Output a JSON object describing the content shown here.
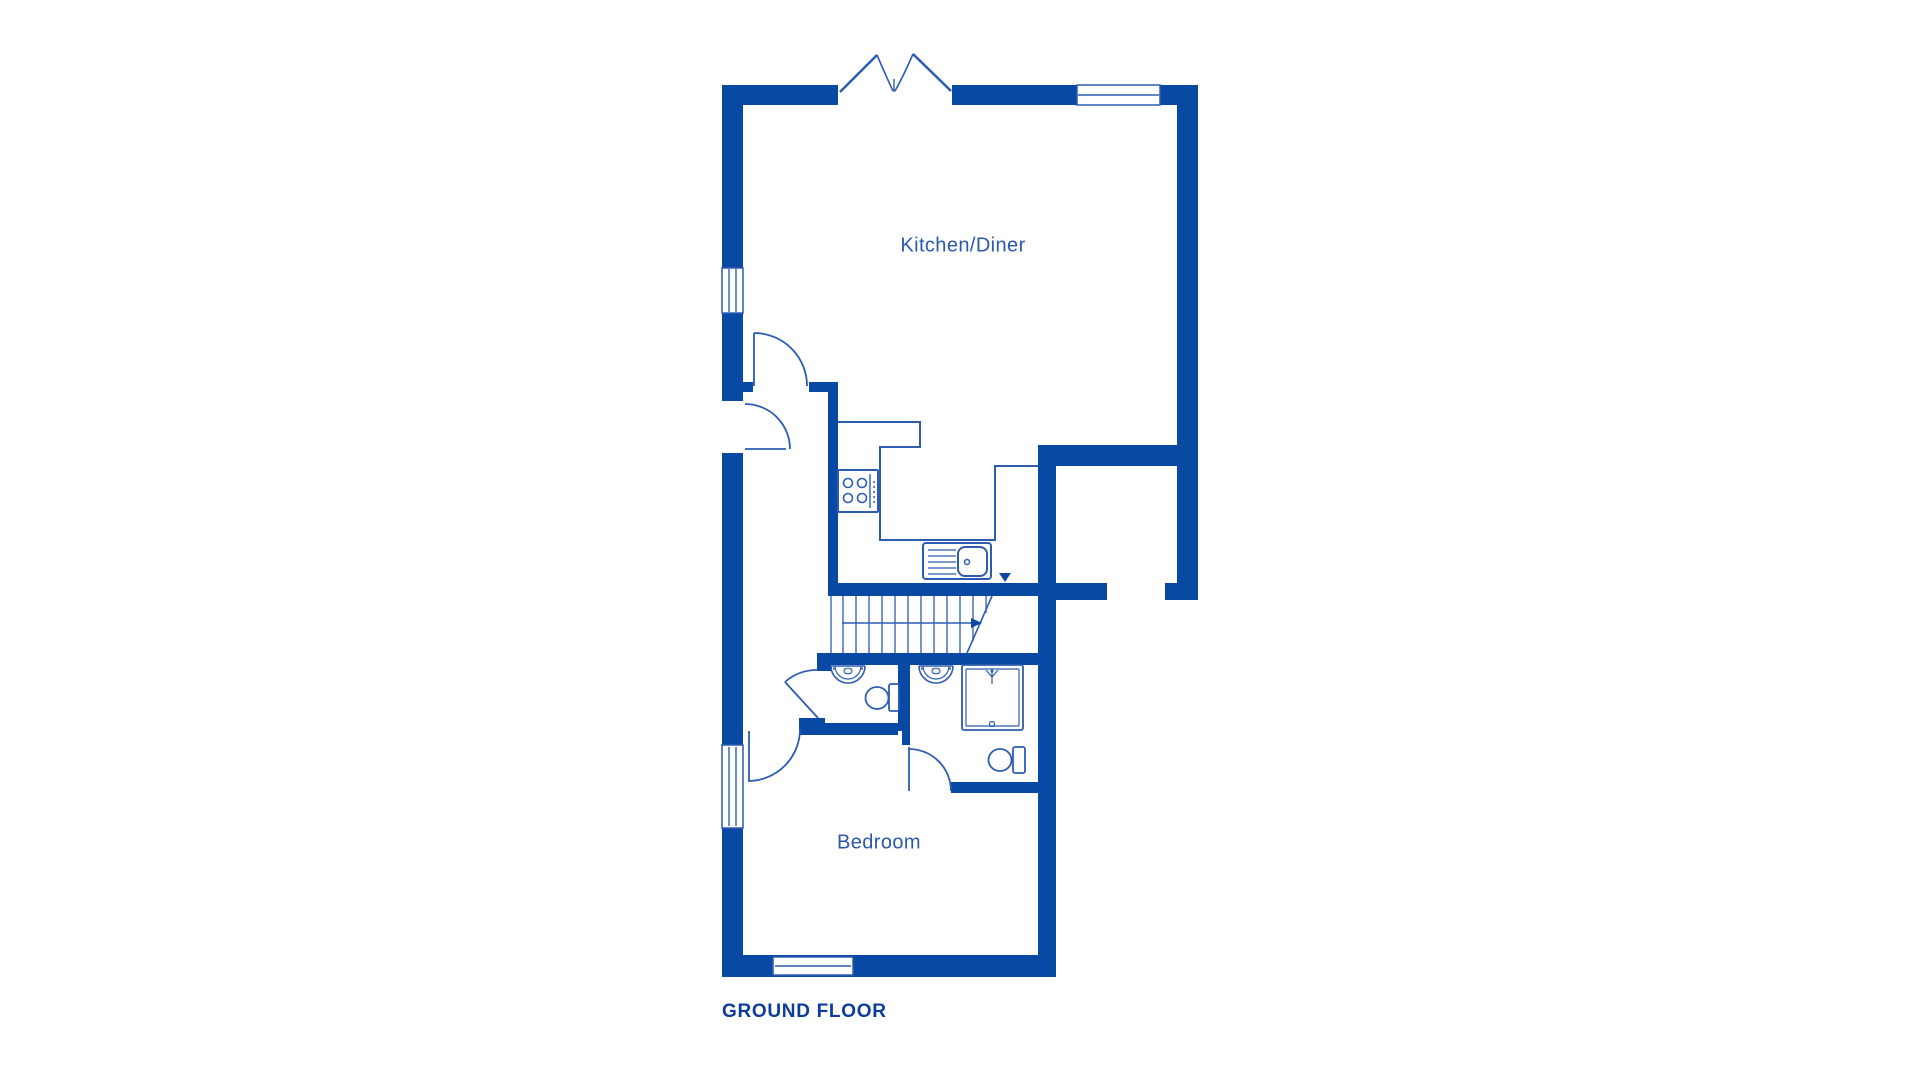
{
  "labels": {
    "kitchen": "Kitchen/Diner",
    "bedroom": "Bedroom",
    "floor_title": "GROUND FLOOR"
  },
  "colors": {
    "wall": "#0849a4",
    "line": "#2d5cb0",
    "label_text": "#2a58ac",
    "floor_title_text": "#0d3c9b",
    "background": "#ffffff"
  },
  "plan": {
    "wallRects": [
      [
        722,
        85,
        116,
        20
      ],
      [
        952,
        85,
        246,
        20
      ],
      [
        1177,
        85,
        21,
        498
      ],
      [
        1165,
        583,
        33,
        17
      ],
      [
        722,
        85,
        21,
        183
      ],
      [
        722,
        313,
        21,
        88
      ],
      [
        722,
        453,
        21,
        292
      ],
      [
        722,
        828,
        21,
        149
      ],
      [
        722,
        955,
        333,
        22
      ],
      [
        1038,
        445,
        140,
        21
      ],
      [
        1038,
        445,
        18,
        532
      ],
      [
        1038,
        583,
        69,
        17
      ],
      [
        828,
        583,
        211,
        13
      ],
      [
        828,
        382,
        10,
        205
      ],
      [
        722,
        382,
        31,
        10
      ],
      [
        809,
        382,
        29,
        10
      ],
      [
        817,
        653,
        238,
        12
      ],
      [
        817,
        665,
        14,
        6
      ],
      [
        799,
        718,
        26,
        17
      ],
      [
        802,
        723,
        96,
        12
      ],
      [
        898,
        653,
        12,
        78
      ],
      [
        902,
        731,
        8,
        14
      ],
      [
        951,
        782,
        104,
        11
      ]
    ],
    "windowRects": [
      [
        722,
        268,
        21,
        45
      ],
      [
        722,
        745,
        21,
        83
      ],
      [
        1077,
        85,
        83,
        20
      ],
      [
        773,
        957,
        80,
        18
      ]
    ],
    "lines": [
      [
        729,
        269,
        729,
        312,
        1.4
      ],
      [
        736,
        269,
        736,
        312,
        1.4
      ],
      [
        729,
        747,
        729,
        826,
        1.4
      ],
      [
        736,
        747,
        736,
        826,
        1.4
      ],
      [
        1078,
        95,
        1159,
        95,
        1.4
      ],
      [
        775,
        966,
        851,
        966,
        1.4
      ],
      [
        754,
        333,
        754,
        386,
        1.8
      ],
      [
        745,
        449,
        786,
        449,
        1.8
      ],
      [
        818,
        718,
        785,
        682,
        1.8
      ],
      [
        749,
        731,
        749,
        781,
        1.8
      ],
      [
        909,
        747,
        909,
        791,
        1.8
      ],
      [
        840,
        92,
        877,
        55,
        2.6
      ],
      [
        951,
        91,
        913,
        54,
        2.6
      ],
      [
        894,
        79,
        894,
        92,
        1.4
      ],
      [
        870,
        474,
        870,
        508,
        1.4
      ],
      [
        928,
        550,
        956,
        550,
        1.2
      ],
      [
        928,
        556,
        956,
        556,
        1.2
      ],
      [
        928,
        562,
        956,
        562,
        1.2
      ],
      [
        928,
        568,
        956,
        568,
        1.2
      ],
      [
        928,
        574,
        956,
        574,
        1.2
      ],
      [
        831,
        596,
        831,
        653,
        1.3
      ],
      [
        843,
        596,
        843,
        653,
        1.3
      ],
      [
        856,
        596,
        856,
        653,
        1.3
      ],
      [
        869,
        596,
        869,
        653,
        1.3
      ],
      [
        882,
        596,
        882,
        653,
        1.3
      ],
      [
        895,
        596,
        895,
        653,
        1.3
      ],
      [
        908,
        596,
        908,
        653,
        1.3
      ],
      [
        921,
        596,
        921,
        653,
        1.3
      ],
      [
        934,
        596,
        934,
        653,
        1.3
      ],
      [
        947,
        596,
        947,
        653,
        1.3
      ],
      [
        960,
        596,
        960,
        653,
        1.3
      ],
      [
        973,
        596,
        973,
        641,
        1.3
      ],
      [
        986,
        596,
        986,
        613,
        1.3
      ],
      [
        992,
        596,
        967,
        653,
        1.6
      ],
      [
        842,
        623,
        971,
        623,
        1.6
      ],
      [
        831,
        666,
        865,
        666,
        1.6
      ],
      [
        919,
        666,
        953,
        666,
        1.6
      ],
      [
        992,
        671,
        992,
        684,
        1.2
      ],
      [
        986,
        670,
        992,
        677,
        1.2
      ],
      [
        998,
        670,
        992,
        677,
        1.2
      ]
    ],
    "paths": [
      [
        "M754 333 A53 53 0 0 1 807 386",
        1.8
      ],
      [
        "M745 404 A45 45 0 0 1 790 449",
        1.8
      ],
      [
        "M785 682 A48 48 0 0 1 818 670",
        1.8
      ],
      [
        "M800 729 A52 52 0 0 1 748 781",
        1.8
      ],
      [
        "M909 749 A42 42 0 0 1 951 791",
        1.8
      ],
      [
        "M877 55 Q886 76 893 91",
        1.6
      ],
      [
        "M913 54 Q904 75 895 91",
        1.6
      ],
      [
        "M831 666 A17 17 0 0 0 865 666",
        1.6
      ],
      [
        "M835 666 A13 13 0 0 0 861 666",
        1.2
      ],
      [
        "M919 666 A17 17 0 0 0 953 666",
        1.6
      ],
      [
        "M923 666 A13 13 0 0 0 949 666",
        1.2
      ]
    ],
    "polylines": [
      {
        "pts": [
          [
            838,
            422
          ],
          [
            920,
            422
          ],
          [
            920,
            447
          ],
          [
            880,
            447
          ],
          [
            880,
            540
          ],
          [
            995,
            540
          ],
          [
            995,
            466
          ],
          [
            1038,
            466
          ]
        ],
        "sw": 2
      }
    ],
    "strokeRects": [
      [
        838,
        470,
        40,
        42,
        1,
        2
      ],
      [
        923,
        543,
        68,
        36,
        3,
        2
      ],
      [
        958,
        547,
        29,
        29,
        7,
        2
      ],
      [
        889,
        684,
        10,
        27,
        2,
        1.8
      ],
      [
        1013,
        747,
        12,
        26,
        2,
        1.8
      ],
      [
        962,
        665,
        61,
        65,
        2,
        1.8
      ],
      [
        966,
        669,
        53,
        57,
        1,
        1.2
      ]
    ],
    "strokeCircles": [
      [
        848,
        483,
        4.5,
        1.6
      ],
      [
        862,
        483,
        4.5,
        1.6
      ],
      [
        848,
        498,
        4.5,
        1.6
      ],
      [
        862,
        498,
        4.5,
        1.6
      ],
      [
        967,
        562,
        2.5,
        1.5
      ],
      [
        992,
        724,
        2.5,
        1.3
      ]
    ],
    "fillCircles": [
      [
        874,
        482,
        1
      ],
      [
        874,
        487,
        1
      ],
      [
        874,
        492,
        1
      ],
      [
        874,
        497,
        1
      ],
      [
        874,
        502,
        1
      ],
      [
        834,
        668.5,
        1.1
      ],
      [
        862,
        668.5,
        1.1
      ],
      [
        922,
        668.5,
        1.1
      ],
      [
        950,
        668.5,
        1.1
      ],
      [
        992,
        671,
        1.5
      ]
    ],
    "strokeEllipses": [
      [
        877,
        698,
        11.5,
        11,
        1.8
      ],
      [
        1000,
        760,
        11.5,
        11,
        1.8
      ],
      [
        848,
        671,
        4,
        2.8,
        1.2
      ],
      [
        936,
        671,
        4,
        2.8,
        1.2
      ]
    ],
    "fillPolygons": [
      [
        999,
        573,
        1011,
        573,
        1005,
        582
      ],
      [
        971,
        618,
        971,
        628,
        982,
        623
      ]
    ]
  }
}
